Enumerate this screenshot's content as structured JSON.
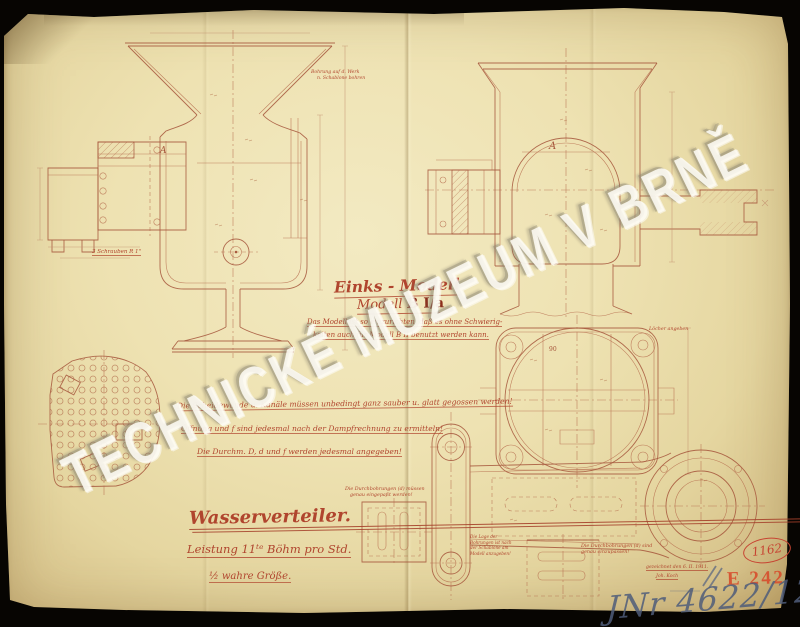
{
  "watermark": "TECHNICKÉ MUZEUM V BRNĚ",
  "title_block": {
    "line1": "Einks - Modell",
    "line2_prefix": "Modell ",
    "line2_model": "B I/a",
    "note1": "Das Modell ist so einzurichten, daß es ohne Schwierig-",
    "note2": "keiten auch für Modell B II benutzt werden kann."
  },
  "instructions": {
    "line1": "Die Scheidewände u. Kanäle müssen unbedingt ganz sauber u. glatt gegossen werden!",
    "line2": "Öffnung und f sind jedesmal nach der Dampfrechnung zu ermitteln!",
    "line3": "Die Durchm. D, d und f werden jedesmal angegeben!"
  },
  "caption": {
    "title": "Wasserverteiler.",
    "subtitle": "Leistung 11ᵗᵉ Böhm pro Std.",
    "scale": "½ wahre Größe."
  },
  "annotations": {
    "funnel_note1": "Bohrung auf d. Werk",
    "funnel_note2": "n. Schablone bohren",
    "screws_label": "3 Schrauben R 1\"",
    "plan_note": "Löcher angeben",
    "detail_a_note1": "Die Durchbohrungen (d) müssen",
    "detail_a_note2": "genau eingepaßt werden!",
    "detail_b_note1": "Die Durchbohrungen (d) sind",
    "detail_b_note2": "genau einzupassen!",
    "detail_c_note1": "Die Lage der",
    "detail_c_note2": "Bohrungen ist nach",
    "detail_c_note3": "der Schablone am",
    "detail_c_note4": "Modell anzugeben!",
    "label_a": "A",
    "dim_90": "90"
  },
  "marks": {
    "date_line1": "gezeichnet den 6. II. 1911.",
    "date_line2": "Joh. Koch",
    "stamp": "E 242",
    "circled_number": "1162",
    "handwritten_number": "JNr 4622/12"
  },
  "colors": {
    "ink": "#a6563c",
    "red_script": "#b0452e",
    "stamp_red": "#d7502f",
    "pencil_blue": "#4f5d7a",
    "paper": "#ece0b0",
    "background": "#070502"
  }
}
